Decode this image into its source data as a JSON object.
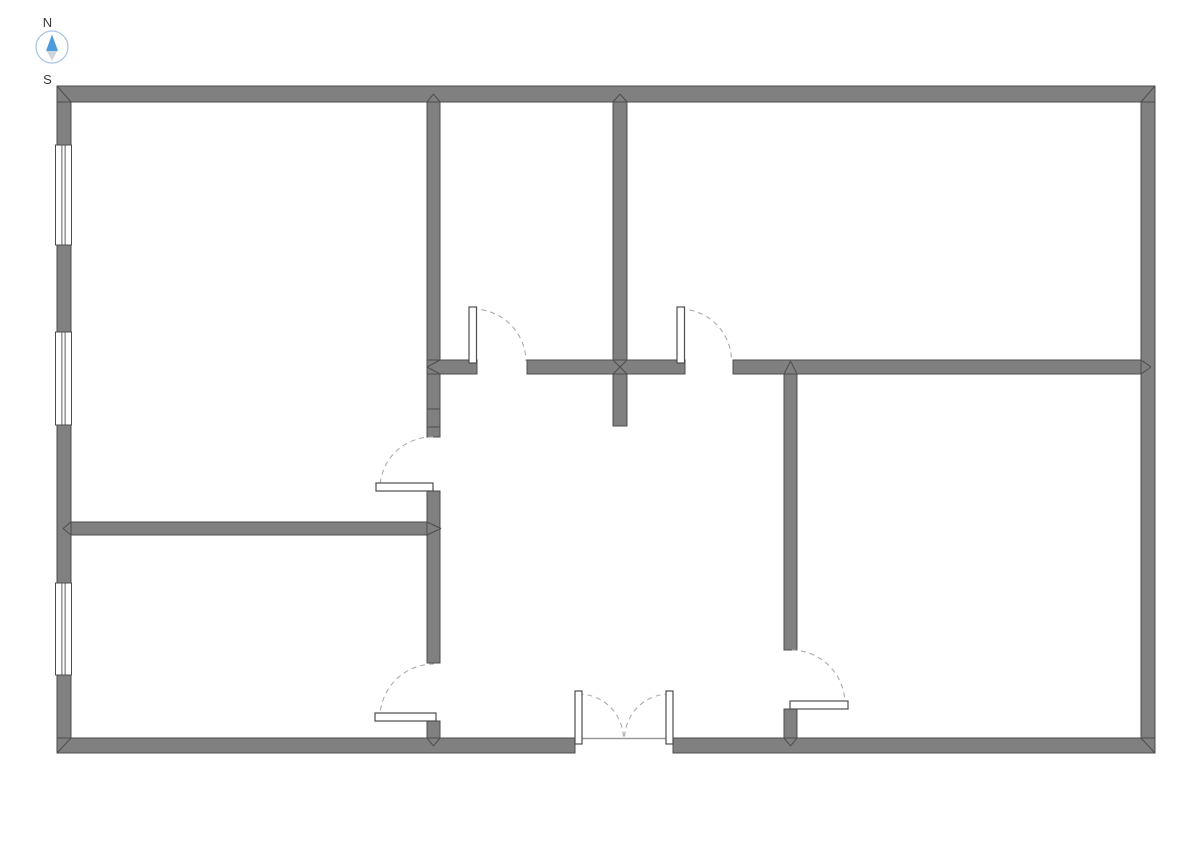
{
  "compass": {
    "north_label": "N",
    "south_label": "S",
    "cx": 52,
    "cy": 47,
    "r": 16,
    "ring_color": "#a9c6e3",
    "needle_north_color": "#4d9bd9",
    "needle_south_color": "#cdd5db",
    "label_color": "#3a3a3a"
  },
  "palette": {
    "background": "#ffffff",
    "wall_fill": "#808080",
    "wall_stroke": "#4d4d4d",
    "window_fill": "#ffffff",
    "window_stroke": "#4d4d4d",
    "door_leaf_fill": "#ffffff",
    "door_leaf_stroke": "#4d4d4d",
    "door_arc_color": "#ababab",
    "threshold_color": "#9a9a9a"
  },
  "floorplan": {
    "canvas": {
      "width": 1190,
      "height": 842
    },
    "walls": [
      {
        "id": "v1-upper",
        "x": 427,
        "y": 100,
        "w": 13,
        "h": 260
      },
      {
        "id": "v1-mid",
        "x": 427,
        "y": 374,
        "w": 13,
        "h": 63
      },
      {
        "id": "v1-lower",
        "x": 427,
        "y": 491,
        "w": 13,
        "h": 172
      },
      {
        "id": "v1-south-stub",
        "x": 427,
        "y": 721,
        "w": 13,
        "h": 18
      },
      {
        "id": "v2-partition",
        "x": 613,
        "y": 100,
        "w": 14,
        "h": 326
      },
      {
        "id": "v3-upper",
        "x": 784,
        "y": 360,
        "w": 13,
        "h": 290
      },
      {
        "id": "v3-south-stub",
        "x": 784,
        "y": 709,
        "w": 13,
        "h": 30
      },
      {
        "id": "hmid-west",
        "x": 427,
        "y": 360,
        "w": 50,
        "h": 14
      },
      {
        "id": "hmid-center",
        "x": 527,
        "y": 360,
        "w": 158,
        "h": 14
      },
      {
        "id": "hmid-east",
        "x": 733,
        "y": 360,
        "w": 408,
        "h": 14
      },
      {
        "id": "hleft-partition",
        "x": 71,
        "y": 522,
        "w": 356,
        "h": 13
      },
      {
        "id": "outer-left",
        "x": 57,
        "y": 86,
        "w": 14,
        "h": 667
      },
      {
        "id": "outer-right",
        "x": 1141,
        "y": 86,
        "w": 14,
        "h": 667
      },
      {
        "id": "outer-top",
        "x": 57,
        "y": 86,
        "w": 1098,
        "h": 16
      },
      {
        "id": "outer-bottom-west",
        "x": 57,
        "y": 738,
        "w": 518,
        "h": 15
      },
      {
        "id": "outer-bottom-east",
        "x": 673,
        "y": 738,
        "w": 482,
        "h": 15
      }
    ],
    "wall_joints": [
      [
        427,
        409,
        440,
        409
      ],
      [
        427,
        427,
        440,
        427
      ]
    ],
    "miters": [
      [
        57,
        86,
        71,
        102
      ],
      [
        1155,
        86,
        1141,
        102
      ],
      [
        57,
        753,
        71,
        738
      ],
      [
        1155,
        753,
        1141,
        738
      ],
      [
        427,
        102,
        433.5,
        94
      ],
      [
        440,
        102,
        433.5,
        94
      ],
      [
        613,
        102,
        620,
        94
      ],
      [
        627,
        102,
        620,
        94
      ],
      [
        613,
        360,
        627,
        374
      ],
      [
        627,
        360,
        613,
        374
      ],
      [
        440,
        360,
        427,
        367
      ],
      [
        440,
        374,
        427,
        367
      ],
      [
        1141,
        360,
        1151,
        367
      ],
      [
        1141,
        374,
        1151,
        367
      ],
      [
        784,
        374,
        790.5,
        361
      ],
      [
        797,
        374,
        790.5,
        361
      ],
      [
        71,
        522,
        63,
        528.5
      ],
      [
        71,
        535,
        63,
        528.5
      ],
      [
        427,
        522,
        441,
        528.5
      ],
      [
        427,
        535,
        441,
        528.5
      ],
      [
        427,
        738,
        433.5,
        746
      ],
      [
        440,
        738,
        433.5,
        746
      ],
      [
        784,
        738,
        790.5,
        746
      ],
      [
        797,
        738,
        790.5,
        746
      ]
    ],
    "windows": [
      {
        "id": "window-1",
        "x": 55.5,
        "y": 145,
        "w": 16,
        "h": 100
      },
      {
        "id": "window-2",
        "x": 55.5,
        "y": 332,
        "w": 16,
        "h": 93
      },
      {
        "id": "window-3",
        "x": 55.5,
        "y": 583,
        "w": 16,
        "h": 92
      }
    ],
    "thresholds": [
      {
        "x1": 575,
        "y1": 738.5,
        "x2": 673,
        "y2": 738.5
      }
    ],
    "doors": [
      {
        "id": "door-top-middle-room",
        "leaf": {
          "x": 469,
          "y": 307,
          "w": 7.5,
          "h": 56
        },
        "arc": {
          "sx": 472.5,
          "sy": 309,
          "ex": 526,
          "ey": 361,
          "r": 53,
          "sweep": 1
        }
      },
      {
        "id": "door-top-right-room",
        "leaf": {
          "x": 677,
          "y": 307,
          "w": 7.5,
          "h": 56
        },
        "arc": {
          "sx": 680.5,
          "sy": 309,
          "ex": 731.5,
          "ey": 361,
          "r": 52,
          "sweep": 1
        }
      },
      {
        "id": "door-left-room",
        "leaf": {
          "x": 376,
          "y": 483,
          "w": 57,
          "h": 8
        },
        "arc": {
          "sx": 433,
          "sy": 437,
          "ex": 380,
          "ey": 486,
          "r": 52,
          "sweep": 0
        }
      },
      {
        "id": "door-bottom-left-room",
        "leaf": {
          "x": 375,
          "y": 713,
          "w": 61,
          "h": 8
        },
        "arc": {
          "sx": 434,
          "sy": 664,
          "ex": 380,
          "ey": 715,
          "r": 54,
          "sweep": 0
        }
      },
      {
        "id": "door-bottom-right-room",
        "leaf": {
          "x": 790,
          "y": 701,
          "w": 58,
          "h": 8
        },
        "arc": {
          "sx": 792,
          "sy": 650,
          "ex": 845,
          "ey": 704,
          "r": 54,
          "sweep": 1
        }
      },
      {
        "id": "entry-double-door-left",
        "leaf": {
          "x": 575,
          "y": 691,
          "w": 7,
          "h": 53
        },
        "arc": {
          "sx": 578.5,
          "sy": 694,
          "ex": 623.5,
          "ey": 738,
          "r": 45,
          "sweep": 1
        }
      },
      {
        "id": "entry-double-door-right",
        "leaf": {
          "x": 666,
          "y": 691,
          "w": 7,
          "h": 53
        },
        "arc": {
          "sx": 669.5,
          "sy": 694,
          "ex": 624.5,
          "ey": 738,
          "r": 45,
          "sweep": 0
        }
      }
    ]
  }
}
